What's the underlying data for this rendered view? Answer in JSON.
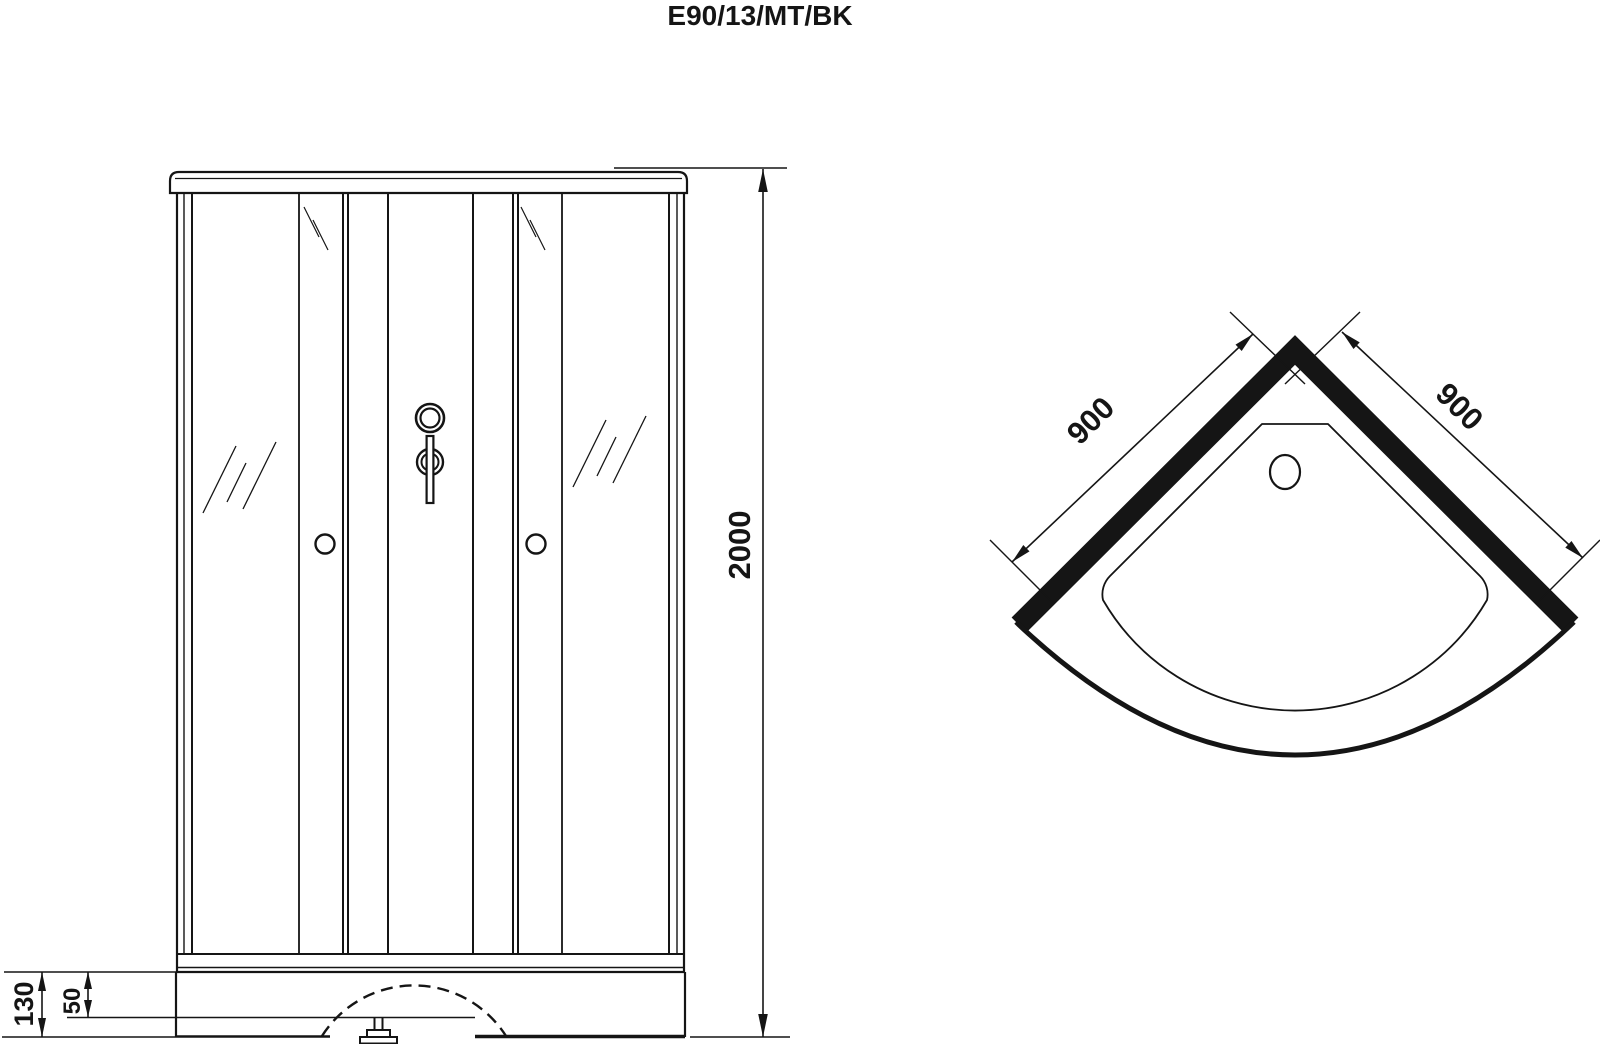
{
  "title": "E90/13/MT/BK",
  "front_view": {
    "dim_height_mm": "2000",
    "dim_base_height_mm": "130",
    "dim_tray_rim_mm": "50"
  },
  "plan_view": {
    "dim_left_side_mm": "900",
    "dim_right_side_mm": "900"
  },
  "colors": {
    "ink": "#151515",
    "background": "#ffffff"
  }
}
